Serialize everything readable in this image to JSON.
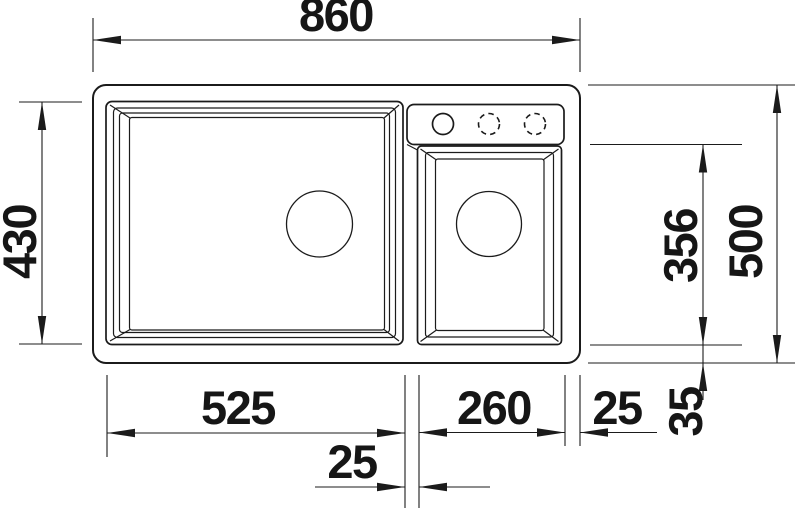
{
  "drawing": {
    "kind": "technical-dimension-drawing",
    "subject": "double-bowl kitchen sink, top view",
    "background": "#ffffff",
    "line_color": "#1b1b1b",
    "dimensions": {
      "overall_width": "860",
      "left_bowl_depth": "430",
      "right_bowl_depth": "356",
      "overall_depth": "500",
      "left_bowl_width": "525",
      "divider_width": "25",
      "right_bowl_width": "260",
      "right_edge_margin": "25",
      "bottom_edge_margin": "35"
    },
    "features": {
      "faucet_holes_solid": "1",
      "faucet_holes_dashed": "2",
      "drain_openings": "2"
    }
  }
}
